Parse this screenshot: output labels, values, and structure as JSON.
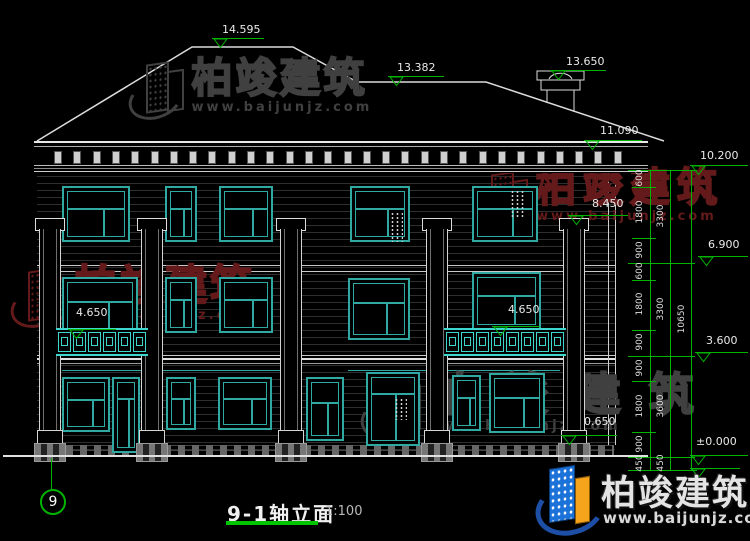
{
  "drawing": {
    "title": "9-1轴立面",
    "scale": "1:100",
    "axis": "9",
    "colors": {
      "cad_green": "#00b300",
      "window_teal": "#2fa9a2",
      "railing_teal": "#3fd6ce",
      "line_white": "#e8e8e8",
      "watermark_red": "#6b1d1d",
      "watermark_gray": "#404040"
    },
    "elevation_markers": [
      {
        "value": "14.595",
        "tx": 222,
        "ty": 23,
        "lx": 212,
        "ly": 38,
        "lw": 52
      },
      {
        "value": "13.382",
        "tx": 397,
        "ty": 61,
        "lx": 388,
        "ly": 76,
        "lw": 56
      },
      {
        "value": "13.650",
        "tx": 566,
        "ty": 55,
        "lx": 550,
        "ly": 70,
        "lw": 56
      },
      {
        "value": "11.090",
        "tx": 600,
        "ty": 124,
        "lx": 584,
        "ly": 140,
        "lw": 58
      },
      {
        "value": "10.200",
        "tx": 700,
        "ty": 149,
        "lx": 690,
        "ly": 165,
        "lw": 58
      },
      {
        "value": "8.450",
        "tx": 592,
        "ty": 197,
        "lx": 568,
        "ly": 215,
        "lw": 60
      },
      {
        "value": "6.900",
        "tx": 708,
        "ty": 238,
        "lx": 698,
        "ly": 256,
        "lw": 50
      },
      {
        "value": "4.650",
        "tx": 76,
        "ty": 306,
        "lx": 68,
        "ly": 329,
        "lw": 48
      },
      {
        "value": "4.650",
        "tx": 508,
        "ty": 303,
        "lx": 492,
        "ly": 326,
        "lw": 48
      },
      {
        "value": "3.600",
        "tx": 706,
        "ty": 334,
        "lx": 695,
        "ly": 352,
        "lw": 53
      },
      {
        "value": "0.650",
        "tx": 584,
        "ty": 415,
        "lx": 561,
        "ly": 435,
        "lw": 56
      },
      {
        "value": "±0.000",
        "tx": 696,
        "ty": 435,
        "lx": 690,
        "ly": 455,
        "lw": 58
      },
      {
        "value": "",
        "tx": 0,
        "ty": 0,
        "lx": 690,
        "ly": 468,
        "lw": 50
      }
    ],
    "dim_chains": [
      {
        "x": 650,
        "label_x": 640,
        "top": 170,
        "bottom": 470,
        "segs": [
          {
            "v": "600",
            "y1": 170,
            "y2": 187
          },
          {
            "v": "1800",
            "y1": 187,
            "y2": 238
          },
          {
            "v": "900",
            "y1": 238,
            "y2": 263
          },
          {
            "v": "600",
            "y1": 263,
            "y2": 280
          },
          {
            "v": "1800",
            "y1": 280,
            "y2": 330
          },
          {
            "v": "900",
            "y1": 330,
            "y2": 356
          },
          {
            "v": "900",
            "y1": 356,
            "y2": 381
          },
          {
            "v": "1800",
            "y1": 381,
            "y2": 432
          },
          {
            "v": "900",
            "y1": 432,
            "y2": 457
          },
          {
            "v": "450",
            "y1": 457,
            "y2": 470
          }
        ]
      },
      {
        "x": 670,
        "label_x": 661,
        "top": 170,
        "bottom": 470,
        "segs": [
          {
            "v": "3300",
            "y1": 170,
            "y2": 263
          },
          {
            "v": "3300",
            "y1": 263,
            "y2": 356
          },
          {
            "v": "3600",
            "y1": 356,
            "y2": 457
          },
          {
            "v": "450",
            "y1": 457,
            "y2": 470
          }
        ]
      },
      {
        "x": 691,
        "label_x": 682,
        "top": 170,
        "bottom": 470,
        "segs": [
          {
            "v": "10650",
            "y1": 170,
            "y2": 470
          }
        ]
      }
    ],
    "group_level_lines": [
      170,
      263,
      356,
      457,
      470
    ],
    "windows": [
      {
        "x": 62,
        "y": 186,
        "w": 68,
        "h": 56,
        "t": "t"
      },
      {
        "x": 165,
        "y": 186,
        "w": 32,
        "h": 56,
        "t": "n"
      },
      {
        "x": 219,
        "y": 186,
        "w": 54,
        "h": 56,
        "t": "t"
      },
      {
        "x": 350,
        "y": 186,
        "w": 60,
        "h": 56,
        "t": "t",
        "vent": [
          38,
          24,
          13,
          30
        ]
      },
      {
        "x": 472,
        "y": 186,
        "w": 66,
        "h": 56,
        "t": "t",
        "vent": [
          36,
          2,
          16,
          28
        ]
      },
      {
        "x": 62,
        "y": 277,
        "w": 76,
        "h": 60,
        "t": "t"
      },
      {
        "x": 165,
        "y": 277,
        "w": 32,
        "h": 56,
        "t": "n"
      },
      {
        "x": 219,
        "y": 277,
        "w": 54,
        "h": 56,
        "t": "t"
      },
      {
        "x": 348,
        "y": 278,
        "w": 62,
        "h": 62,
        "t": "t"
      },
      {
        "x": 472,
        "y": 272,
        "w": 69,
        "h": 58,
        "t": "t"
      },
      {
        "x": 62,
        "y": 377,
        "w": 48,
        "h": 55,
        "t": "t"
      },
      {
        "x": 112,
        "y": 377,
        "w": 28,
        "h": 76,
        "t": "d"
      },
      {
        "x": 166,
        "y": 377,
        "w": 30,
        "h": 53,
        "t": "n"
      },
      {
        "x": 218,
        "y": 377,
        "w": 54,
        "h": 53,
        "t": "t"
      },
      {
        "x": 306,
        "y": 377,
        "w": 38,
        "h": 64,
        "t": "n"
      },
      {
        "x": 366,
        "y": 372,
        "w": 54,
        "h": 74,
        "t": "d",
        "vent": [
          26,
          24,
          13,
          22
        ]
      },
      {
        "x": 452,
        "y": 375,
        "w": 29,
        "h": 56,
        "t": "n"
      },
      {
        "x": 489,
        "y": 373,
        "w": 56,
        "h": 60,
        "t": "t"
      }
    ],
    "pilasters": [
      38,
      140,
      279,
      425,
      562
    ],
    "railings": [
      {
        "x": 56,
        "y": 328,
        "w": 92,
        "h": 28
      },
      {
        "x": 444,
        "y": 328,
        "w": 122,
        "h": 28
      }
    ],
    "watermarks": [
      {
        "id": "top-center",
        "brand": "柏竣建筑",
        "url": "www.baijunjz.com",
        "x": 128,
        "y": 58,
        "color": "#404040",
        "char_size": 41,
        "url_size": 13,
        "spacing": 3
      },
      {
        "id": "left-center",
        "brand": "柏竣建筑",
        "url": "www.baijunjz.com",
        "x": 10,
        "y": 265,
        "color": "#641a1a",
        "char_size": 42,
        "url_size": 13,
        "spacing": 3
      },
      {
        "id": "mid-right",
        "brand": "柏竣建筑",
        "url": "www.baijunjz.com",
        "x": 474,
        "y": 168,
        "color": "#641a1a",
        "char_size": 40,
        "url_size": 13,
        "spacing": 7
      },
      {
        "id": "bottom-center",
        "brand": "柏竣建筑",
        "url": "www.baijunjz.com",
        "x": 360,
        "y": 372,
        "color": "#404040",
        "char_size": 45,
        "url_size": 14,
        "spacing": 28
      }
    ],
    "logo": {
      "brand": "柏竣建筑",
      "url": "www.baijunjz.com"
    }
  }
}
